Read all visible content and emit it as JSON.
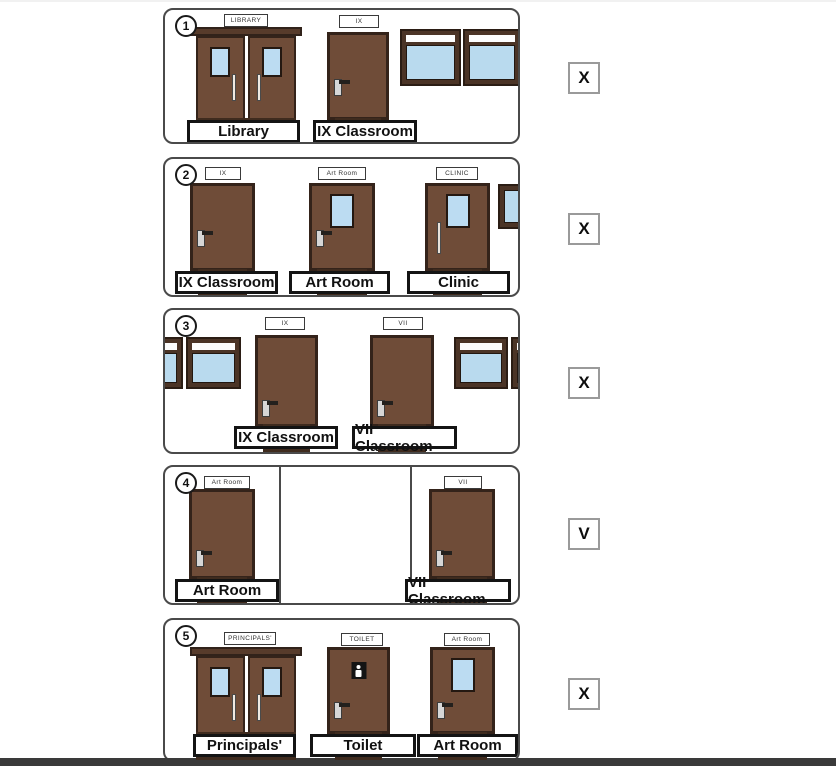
{
  "colors": {
    "door_brown": "#6f4c38",
    "door_frame_dark": "#34231a",
    "window_glass_blue": "#b9daee",
    "window_frame_brown": "#4b3426",
    "bottom_bar": "#3a3a3a"
  },
  "panels": [
    {
      "number": "1",
      "answer": "X",
      "doors": [
        {
          "sign": "LIBRARY",
          "label": "Library"
        },
        {
          "sign": "IX",
          "label": "IX Classroom"
        }
      ]
    },
    {
      "number": "2",
      "answer": "X",
      "doors": [
        {
          "sign": "IX",
          "label": "IX Classroom"
        },
        {
          "sign": "Art Room",
          "label": "Art Room"
        },
        {
          "sign": "CLINIC",
          "label": "Clinic"
        }
      ]
    },
    {
      "number": "3",
      "answer": "X",
      "doors": [
        {
          "sign": "IX",
          "label": "IX Classroom"
        },
        {
          "sign": "VII",
          "label": "VII Classroom"
        }
      ]
    },
    {
      "number": "4",
      "answer": "V",
      "doors": [
        {
          "sign": "Art Room",
          "label": "Art Room"
        },
        {
          "sign": "VII",
          "label": "VII Classroom"
        }
      ]
    },
    {
      "number": "5",
      "answer": "X",
      "doors": [
        {
          "sign": "PRINCIPALS'",
          "label": "Principals'"
        },
        {
          "sign": "TOILET",
          "label": "Toilet"
        },
        {
          "sign": "Art Room",
          "label": "Art Room"
        }
      ]
    }
  ]
}
